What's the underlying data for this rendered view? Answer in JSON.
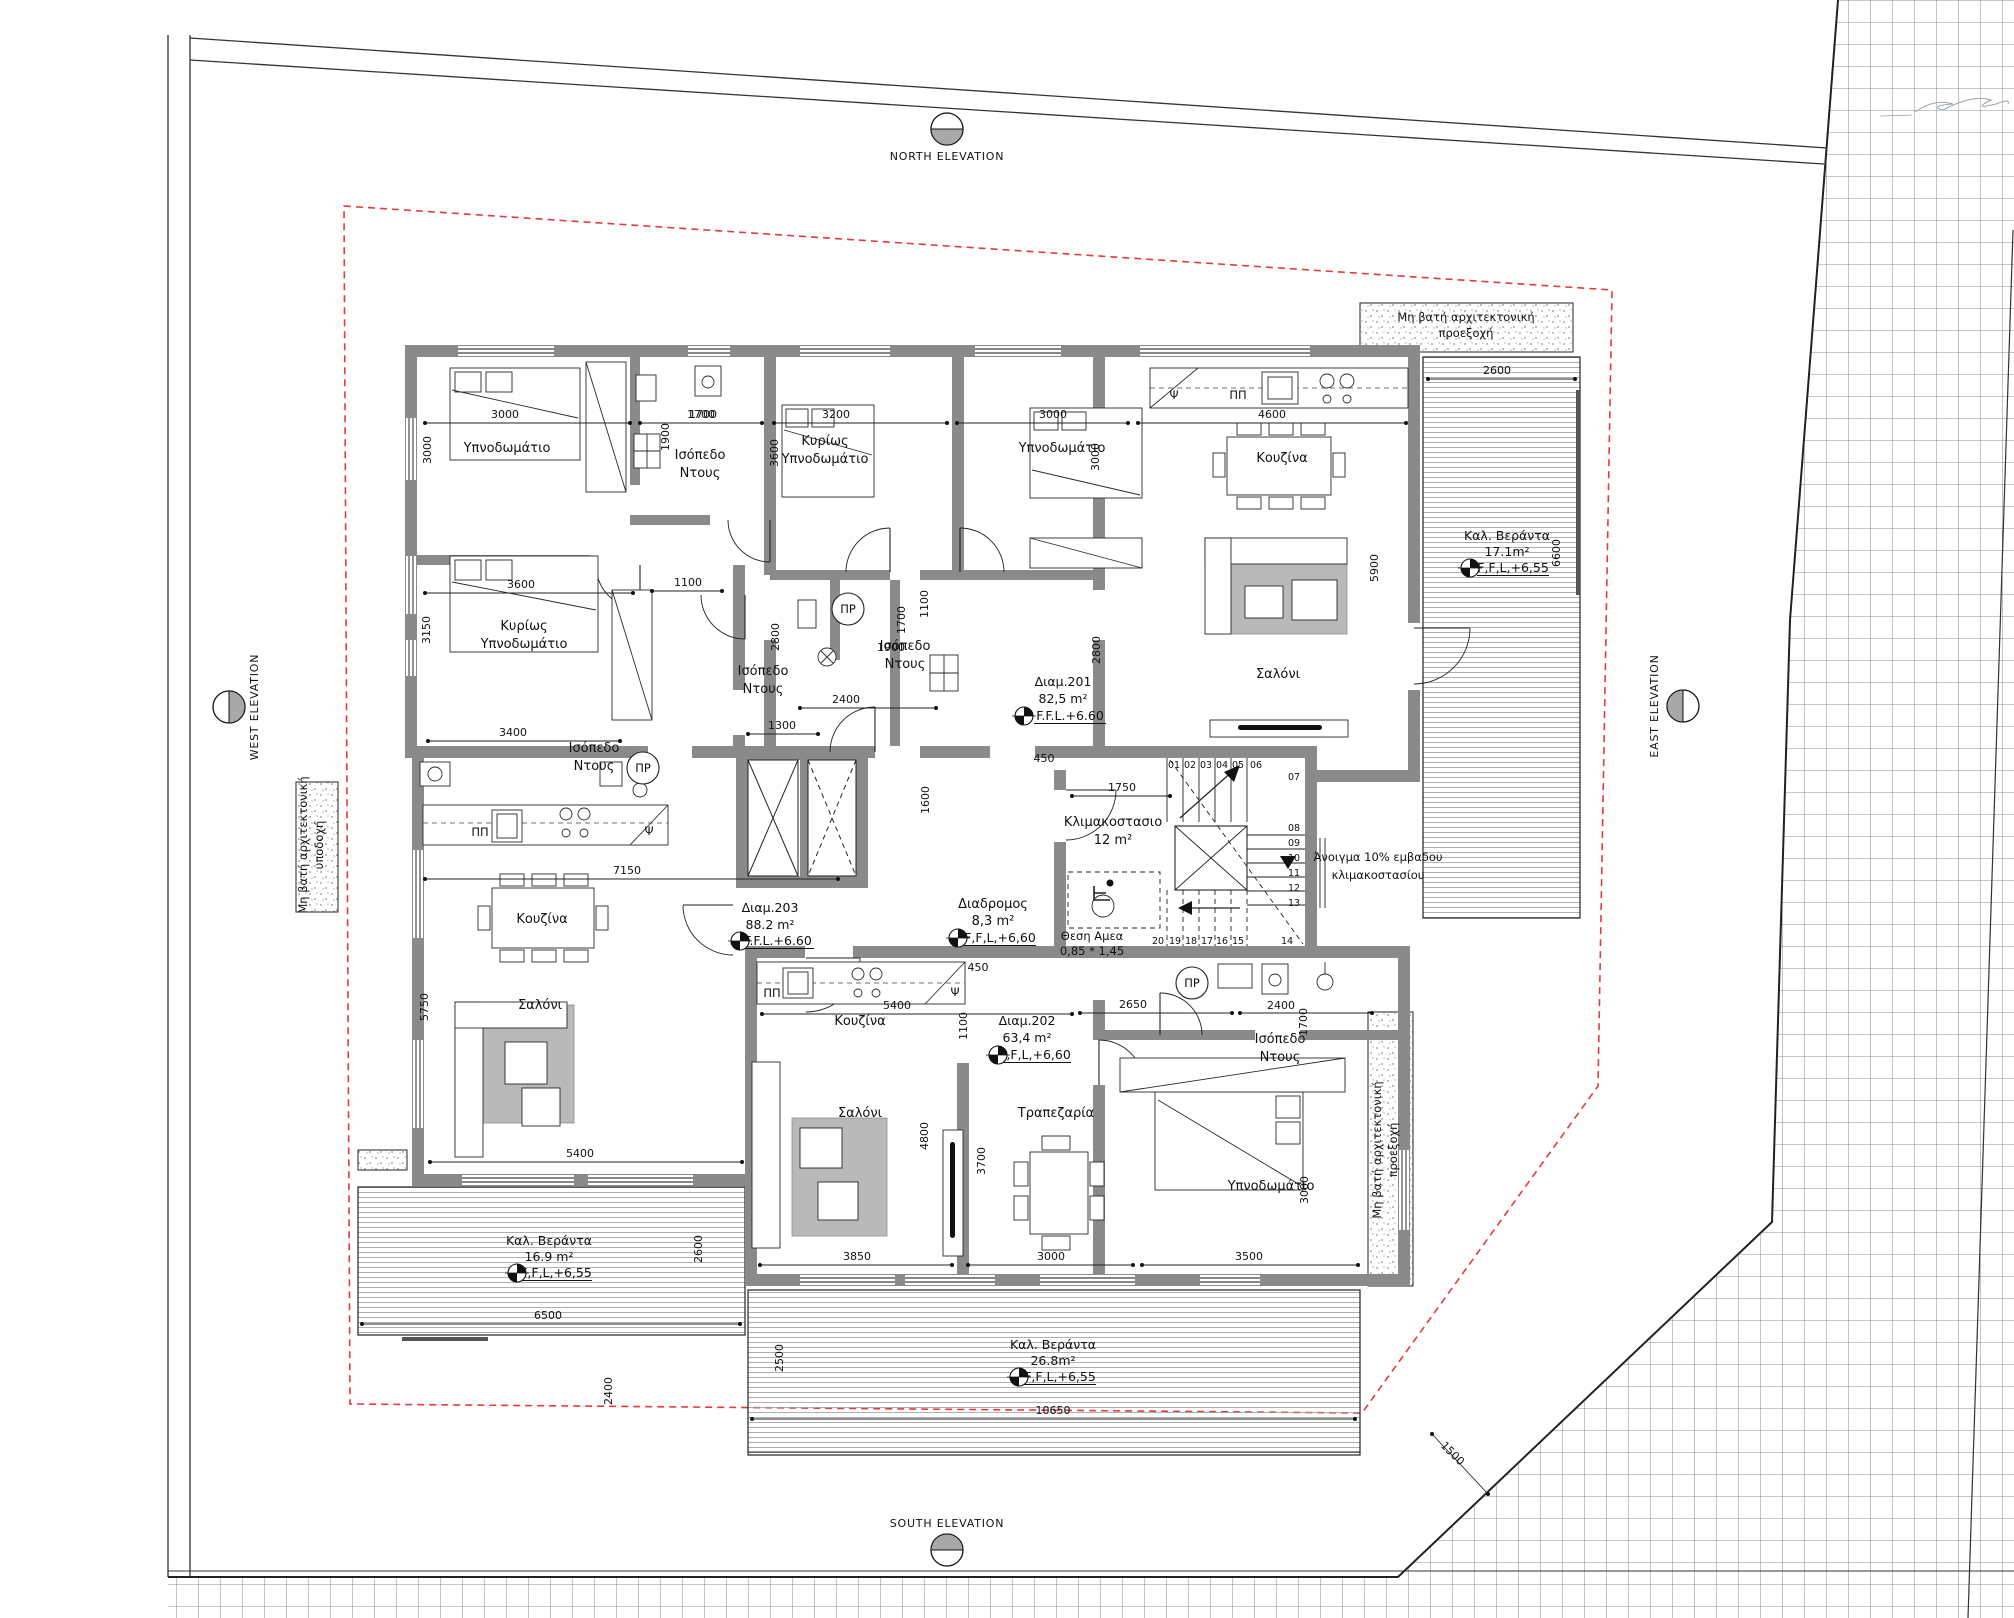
{
  "drawing_type": "apartment floor plan (first floor) with site plan",
  "colors": {
    "wall": "#8a8a8a",
    "setback_line": "#e53a3a",
    "tile_stroke": "#6a6a6a",
    "deck_line": "#9b9b9b",
    "ink": "#111111"
  },
  "elevation_markers": [
    {
      "t": "NORTH ELEVATION",
      "x": 947,
      "y": 129,
      "half": "bottom",
      "tx": 947,
      "ty": 160,
      "vert": false
    },
    {
      "t": "SOUTH ELEVATION",
      "x": 947,
      "y": 1550,
      "half": "top",
      "tx": 947,
      "ty": 1527,
      "vert": false
    },
    {
      "t": "WEST ELEVATION",
      "x": 229,
      "y": 707,
      "half": "right",
      "tx": 258,
      "ty": 707,
      "vert": true
    },
    {
      "t": "EAST ELEVATION",
      "x": 1683,
      "y": 706,
      "half": "left",
      "tx": 1658,
      "ty": 706,
      "vert": true
    }
  ],
  "room_labels": [
    {
      "t": "Υπνοδωμάτιο",
      "x": 507,
      "y": 452,
      "n": "room-bedroom-a1"
    },
    {
      "t": "Κυρίως",
      "x": 524,
      "y": 630,
      "n": "room-master-a"
    },
    {
      "t": "Υπνοδωμάτιο",
      "x": 524,
      "y": 648,
      "n": "room-master-a2"
    },
    {
      "t": "Ισόπεδο",
      "x": 700,
      "y": 459,
      "n": "room-shower-a"
    },
    {
      "t": "Ντους",
      "x": 700,
      "y": 477,
      "n": "room-shower-a2"
    },
    {
      "t": "Ισόπεδο",
      "x": 594,
      "y": 752,
      "n": "room-shower-203"
    },
    {
      "t": "Ντους",
      "x": 594,
      "y": 770,
      "n": "room-shower-203b"
    },
    {
      "t": "Κυρίως",
      "x": 825,
      "y": 445,
      "n": "room-master-b"
    },
    {
      "t": "Υπνοδωμάτιο",
      "x": 825,
      "y": 463,
      "n": "room-master-b2"
    },
    {
      "t": "Υπνοδωμάτιο",
      "x": 1062,
      "y": 452,
      "n": "room-bedroom-b2"
    },
    {
      "t": "Ισόπεδο",
      "x": 763,
      "y": 675,
      "n": "room-shower-b"
    },
    {
      "t": "Ντους",
      "x": 763,
      "y": 693,
      "n": "room-shower-b2"
    },
    {
      "t": "Ισόπεδο",
      "x": 905,
      "y": 650,
      "n": "room-shower-c"
    },
    {
      "t": "Ντους",
      "x": 905,
      "y": 668,
      "n": "room-shower-c2"
    },
    {
      "t": "Κουζίνα",
      "x": 1282,
      "y": 462,
      "n": "room-kitchen-201"
    },
    {
      "t": "Σαλόνι",
      "x": 1278,
      "y": 678,
      "n": "room-living-201"
    },
    {
      "t": "Κουζίνα",
      "x": 542,
      "y": 923,
      "n": "room-kitchen-203"
    },
    {
      "t": "Σαλόνι",
      "x": 540,
      "y": 1009,
      "n": "room-living-203"
    },
    {
      "t": "Κουζίνα",
      "x": 860,
      "y": 1025,
      "n": "room-kitchen-202"
    },
    {
      "t": "Σαλόνι",
      "x": 860,
      "y": 1117,
      "n": "room-living-202"
    },
    {
      "t": "Τραπεζαρία",
      "x": 1056,
      "y": 1117,
      "n": "room-dining-202"
    },
    {
      "t": "Υπνοδωμάτιο",
      "x": 1271,
      "y": 1190,
      "n": "room-bedroom-202"
    },
    {
      "t": "Ισόπεδο",
      "x": 1280,
      "y": 1043,
      "n": "room-shower-202"
    },
    {
      "t": "Ντους",
      "x": 1280,
      "y": 1061,
      "n": "room-shower-202b"
    },
    {
      "t": "Κλιμακοστασιο",
      "x": 1113,
      "y": 826,
      "n": "room-staircase"
    },
    {
      "t": "12 m²",
      "x": 1113,
      "y": 844,
      "n": "room-staircase-area"
    },
    {
      "t": "Διαδρομος",
      "x": 993,
      "y": 908,
      "n": "room-corridor"
    },
    {
      "t": "8,3 m²",
      "x": 993,
      "y": 925,
      "n": "room-corridor-area"
    }
  ],
  "apartment_labels": [
    {
      "t": "Διαμ.201",
      "x": 1063,
      "y": 686,
      "n": "apt-201-name"
    },
    {
      "t": "82,5 m²",
      "x": 1063,
      "y": 703,
      "n": "apt-201-area"
    },
    {
      "t": "F.F.L.+6.60",
      "x": 1070,
      "y": 720,
      "u": 1,
      "n": "apt-201-ffl"
    },
    {
      "t": "Διαμ.202",
      "x": 1027,
      "y": 1025,
      "n": "apt-202-name"
    },
    {
      "t": "63,4 m²",
      "x": 1027,
      "y": 1042,
      "n": "apt-202-area"
    },
    {
      "t": "F,F,L,+6,60",
      "x": 1035,
      "y": 1059,
      "u": 1,
      "n": "apt-202-ffl"
    },
    {
      "t": "Διαμ.203",
      "x": 770,
      "y": 912,
      "n": "apt-203-name"
    },
    {
      "t": "88.2 m²",
      "x": 770,
      "y": 929,
      "n": "apt-203-area"
    },
    {
      "t": "F.F.L.+6.60",
      "x": 778,
      "y": 945,
      "u": 1,
      "n": "apt-203-ffl"
    },
    {
      "t": "F,F,L,+6,60",
      "x": 1000,
      "y": 942,
      "u": 1,
      "n": "corridor-ffl"
    }
  ],
  "veranda_labels": [
    {
      "t": "Καλ. Βεράντα",
      "x": 1507,
      "y": 540,
      "n": "veranda-east-name"
    },
    {
      "t": "17.1m²",
      "x": 1507,
      "y": 556,
      "n": "veranda-east-area"
    },
    {
      "t": "F,F,L,+6,55",
      "x": 1513,
      "y": 572,
      "u": 1,
      "n": "veranda-east-ffl"
    },
    {
      "t": "Καλ. Βεράντα",
      "x": 549,
      "y": 1245,
      "n": "veranda-west-name"
    },
    {
      "t": "16.9 m²",
      "x": 549,
      "y": 1261,
      "n": "veranda-west-area"
    },
    {
      "t": "F,F,L,+6,55",
      "x": 556,
      "y": 1277,
      "u": 1,
      "n": "veranda-west-ffl"
    },
    {
      "t": "Καλ. Βεράντα",
      "x": 1053,
      "y": 1349,
      "n": "veranda-south-name"
    },
    {
      "t": "26.8m²",
      "x": 1053,
      "y": 1365,
      "n": "veranda-south-area"
    },
    {
      "t": "F,F,L,+6,55",
      "x": 1060,
      "y": 1381,
      "u": 1,
      "n": "veranda-south-ffl"
    }
  ],
  "annotation_labels": [
    {
      "t": "Μη βατή αρχιτεκτονική",
      "x": 1466,
      "y": 321,
      "n": "note-projection-top"
    },
    {
      "t": "προεξοχή",
      "x": 1466,
      "y": 337,
      "n": "note-projection-top2"
    },
    {
      "t": "Μη βατή αρχιτεκτονική",
      "x": 1381,
      "y": 1150,
      "r": -90,
      "n": "note-projection-right"
    },
    {
      "t": "προεξοχή",
      "x": 1397,
      "y": 1150,
      "r": -90,
      "n": "note-projection-right2"
    },
    {
      "t": "Μη βατή αρχιτεκτονική",
      "x": 307,
      "y": 845,
      "r": -90,
      "n": "note-projection-left"
    },
    {
      "t": "υποδοχή",
      "x": 323,
      "y": 845,
      "r": -90,
      "n": "note-projection-left2"
    },
    {
      "t": "Άνοιγμα 10% εμβαδου",
      "x": 1378,
      "y": 861,
      "n": "note-stair-opening"
    },
    {
      "t": "κλιμακοστασίου",
      "x": 1378,
      "y": 879,
      "n": "note-stair-opening2"
    },
    {
      "t": "Θεση Αμεα",
      "x": 1092,
      "y": 940,
      "n": "note-wheelchair"
    },
    {
      "t": "0,85 * 1,45",
      "x": 1092,
      "y": 955,
      "n": "note-wheelchair-size"
    }
  ],
  "fixture_labels": [
    {
      "t": "ΠΠ",
      "x": 480,
      "y": 836,
      "n": "label-pp-203"
    },
    {
      "t": "Ψ",
      "x": 649,
      "y": 835,
      "n": "label-psi-203"
    },
    {
      "t": "ΠΠ",
      "x": 1238,
      "y": 399,
      "n": "label-pp-201"
    },
    {
      "t": "Ψ",
      "x": 1174,
      "y": 399,
      "n": "label-psi-201"
    },
    {
      "t": "ΠΠ",
      "x": 772,
      "y": 997,
      "n": "label-pp-202"
    },
    {
      "t": "Ψ",
      "x": 955,
      "y": 996,
      "n": "label-psi-202"
    }
  ],
  "pr_markers": [
    {
      "t": "ΠΡ",
      "x": 643,
      "y": 768
    },
    {
      "t": "ΠΡ",
      "x": 848,
      "y": 609
    },
    {
      "t": "ΠΡ",
      "x": 1192,
      "y": 983
    }
  ],
  "ffl_symbols": [
    {
      "x": 1024,
      "y": 716
    },
    {
      "x": 998,
      "y": 1055
    },
    {
      "x": 740,
      "y": 941
    },
    {
      "x": 958,
      "y": 938
    },
    {
      "x": 1470,
      "y": 568
    },
    {
      "x": 517,
      "y": 1273
    },
    {
      "x": 1019,
      "y": 1377
    }
  ],
  "dimension_labels": [
    {
      "t": "3000",
      "x": 505,
      "y": 418,
      "ln": [
        425,
        423,
        630,
        423
      ]
    },
    {
      "t": "1700",
      "x": 701,
      "y": 418,
      "ln": [
        640,
        423,
        762,
        423
      ]
    },
    {
      "t": "3200",
      "x": 836,
      "y": 418,
      "ln": [
        774,
        423,
        947,
        423
      ]
    },
    {
      "t": "3000",
      "x": 1053,
      "y": 418,
      "ln": [
        957,
        423,
        1128,
        423
      ]
    },
    {
      "t": "4600",
      "x": 1272,
      "y": 418,
      "ln": [
        1138,
        423,
        1406,
        423
      ]
    },
    {
      "t": "2600",
      "x": 1497,
      "y": 374,
      "ln": [
        1428,
        379,
        1575,
        379
      ]
    },
    {
      "t": "3600",
      "x": 521,
      "y": 588,
      "ln": [
        425,
        593,
        633,
        593
      ]
    },
    {
      "t": "1100",
      "x": 688,
      "y": 586,
      "ln": [
        652,
        591,
        722,
        591
      ]
    },
    {
      "t": "3400",
      "x": 513,
      "y": 736,
      "ln": [
        428,
        741,
        620,
        741
      ]
    },
    {
      "t": "7150",
      "x": 627,
      "y": 874,
      "ln": [
        425,
        879,
        838,
        879
      ]
    },
    {
      "t": "5400",
      "x": 580,
      "y": 1157,
      "ln": [
        430,
        1162,
        742,
        1162
      ]
    },
    {
      "t": "6500",
      "x": 548,
      "y": 1319,
      "ln": [
        362,
        1324,
        740,
        1324
      ]
    },
    {
      "t": "5400",
      "x": 897,
      "y": 1009,
      "ln": [
        762,
        1014,
        1072,
        1014
      ]
    },
    {
      "t": "2650",
      "x": 1133,
      "y": 1008,
      "ln": [
        1080,
        1013,
        1232,
        1013
      ]
    },
    {
      "t": "2400",
      "x": 1281,
      "y": 1009,
      "ln": [
        1240,
        1013,
        1372,
        1013
      ]
    },
    {
      "t": "3850",
      "x": 857,
      "y": 1260,
      "ln": [
        760,
        1265,
        952,
        1265
      ]
    },
    {
      "t": "3000",
      "x": 1051,
      "y": 1260,
      "ln": [
        968,
        1265,
        1133,
        1265
      ]
    },
    {
      "t": "3500",
      "x": 1249,
      "y": 1260,
      "ln": [
        1142,
        1265,
        1358,
        1265
      ]
    },
    {
      "t": "10650",
      "x": 1053,
      "y": 1414,
      "ln": [
        752,
        1419,
        1355,
        1419
      ]
    },
    {
      "t": "1750",
      "x": 1122,
      "y": 791,
      "ln": [
        1072,
        796,
        1170,
        796
      ]
    },
    {
      "t": "1300",
      "x": 782,
      "y": 729,
      "ln": [
        748,
        734,
        818,
        734
      ]
    },
    {
      "t": "450",
      "x": 1044,
      "y": 762
    },
    {
      "t": "450",
      "x": 978,
      "y": 971
    },
    {
      "t": "2400",
      "x": 846,
      "y": 703,
      "ln": [
        800,
        708,
        936,
        708
      ]
    },
    {
      "t": "1900",
      "x": 891,
      "y": 651
    },
    {
      "t": "1700",
      "x": 703,
      "y": 418
    },
    {
      "t": "3000",
      "x": 431,
      "y": 450,
      "r": -90
    },
    {
      "t": "3150",
      "x": 430,
      "y": 630,
      "r": -90
    },
    {
      "t": "1900",
      "x": 669,
      "y": 437,
      "r": -90
    },
    {
      "t": "3600",
      "x": 778,
      "y": 453,
      "r": -90
    },
    {
      "t": "3000",
      "x": 1099,
      "y": 457,
      "r": -90
    },
    {
      "t": "2800",
      "x": 1100,
      "y": 650,
      "r": -90
    },
    {
      "t": "5900",
      "x": 1378,
      "y": 568,
      "r": -90
    },
    {
      "t": "6600",
      "x": 1560,
      "y": 553,
      "r": -90
    },
    {
      "t": "1100",
      "x": 928,
      "y": 604,
      "r": -90
    },
    {
      "t": "2800",
      "x": 779,
      "y": 637,
      "r": -90
    },
    {
      "t": "1700",
      "x": 905,
      "y": 620,
      "r": -90
    },
    {
      "t": "1600",
      "x": 929,
      "y": 800,
      "r": -90
    },
    {
      "t": "5750",
      "x": 428,
      "y": 1007,
      "r": -90
    },
    {
      "t": "1100",
      "x": 967,
      "y": 1026,
      "r": -90
    },
    {
      "t": "4800",
      "x": 928,
      "y": 1136,
      "r": -90
    },
    {
      "t": "3700",
      "x": 985,
      "y": 1161,
      "r": -90
    },
    {
      "t": "3000",
      "x": 1308,
      "y": 1190,
      "r": -90
    },
    {
      "t": "1700",
      "x": 1307,
      "y": 1022,
      "r": -90
    },
    {
      "t": "2600",
      "x": 702,
      "y": 1249,
      "r": -90
    },
    {
      "t": "2500",
      "x": 783,
      "y": 1358,
      "r": -90
    },
    {
      "t": "2400",
      "x": 612,
      "y": 1391,
      "r": -90
    },
    {
      "t": "1500",
      "x": 1450,
      "y": 1456,
      "r": 45,
      "ln": [
        1432,
        1434,
        1488,
        1494
      ]
    }
  ],
  "stair_step_labels": [
    {
      "t": "01",
      "x": 1174,
      "y": 768
    },
    {
      "t": "02",
      "x": 1190,
      "y": 768
    },
    {
      "t": "03",
      "x": 1206,
      "y": 768
    },
    {
      "t": "04",
      "x": 1222,
      "y": 768
    },
    {
      "t": "05",
      "x": 1238,
      "y": 768
    },
    {
      "t": "06",
      "x": 1256,
      "y": 768
    },
    {
      "t": "07",
      "x": 1294,
      "y": 780
    },
    {
      "t": "08",
      "x": 1294,
      "y": 831
    },
    {
      "t": "09",
      "x": 1294,
      "y": 846
    },
    {
      "t": "10",
      "x": 1294,
      "y": 861
    },
    {
      "t": "11",
      "x": 1294,
      "y": 876
    },
    {
      "t": "12",
      "x": 1294,
      "y": 891
    },
    {
      "t": "13",
      "x": 1294,
      "y": 906
    },
    {
      "t": "14",
      "x": 1287,
      "y": 944
    },
    {
      "t": "15",
      "x": 1238,
      "y": 944
    },
    {
      "t": "16",
      "x": 1222,
      "y": 944
    },
    {
      "t": "17",
      "x": 1207,
      "y": 944
    },
    {
      "t": "18",
      "x": 1191,
      "y": 944
    },
    {
      "t": "19",
      "x": 1175,
      "y": 944
    },
    {
      "t": "20",
      "x": 1158,
      "y": 944
    }
  ]
}
